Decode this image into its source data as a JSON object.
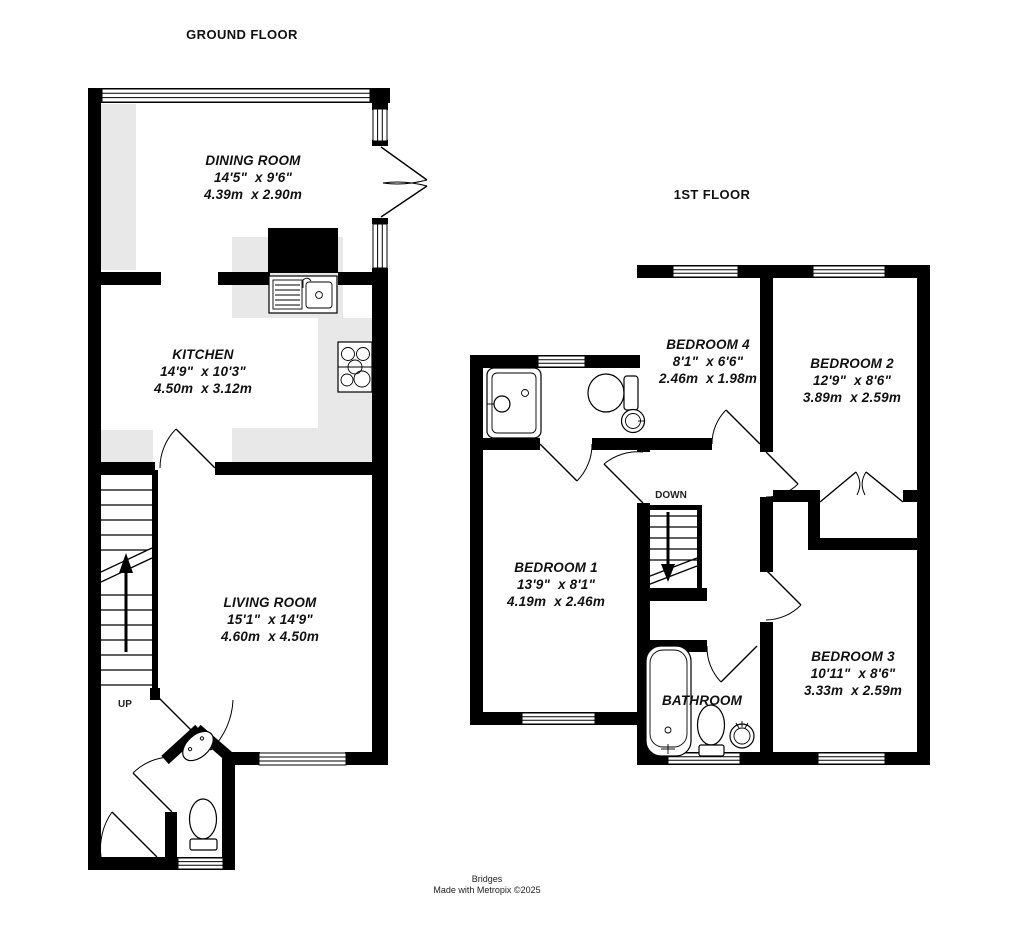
{
  "colors": {
    "wall": "#000000",
    "counter": "#e8e8e8",
    "background": "#ffffff"
  },
  "floors": {
    "ground": {
      "title": "GROUND FLOOR",
      "stairs_label": "UP",
      "rooms": {
        "dining": {
          "name": "DINING ROOM",
          "imperial": "14'5\"  x 9'6\"",
          "metric": "4.39m  x 2.90m"
        },
        "kitchen": {
          "name": "KITCHEN",
          "imperial": "14'9\"  x 10'3\"",
          "metric": "4.50m  x 3.12m"
        },
        "living": {
          "name": "LIVING ROOM",
          "imperial": "15'1\"  x 14'9\"",
          "metric": "4.60m  x 4.50m"
        }
      }
    },
    "first": {
      "title": "1ST FLOOR",
      "stairs_label": "DOWN",
      "rooms": {
        "bedroom1": {
          "name": "BEDROOM 1",
          "imperial": "13'9\"  x 8'1\"",
          "metric": "4.19m  x 2.46m"
        },
        "bedroom2": {
          "name": "BEDROOM 2",
          "imperial": "12'9\"  x 8'6\"",
          "metric": "3.89m  x 2.59m"
        },
        "bedroom3": {
          "name": "BEDROOM 3",
          "imperial": "10'11\"  x 8'6\"",
          "metric": "3.33m  x 2.59m"
        },
        "bedroom4": {
          "name": "BEDROOM 4",
          "imperial": "8'1\"  x 6'6\"",
          "metric": "2.46m  x 1.98m"
        },
        "bathroom": {
          "name": "BATHROOM"
        }
      }
    }
  },
  "footer": {
    "line1": "Bridges",
    "line2": "Made with Metropix ©2025"
  }
}
